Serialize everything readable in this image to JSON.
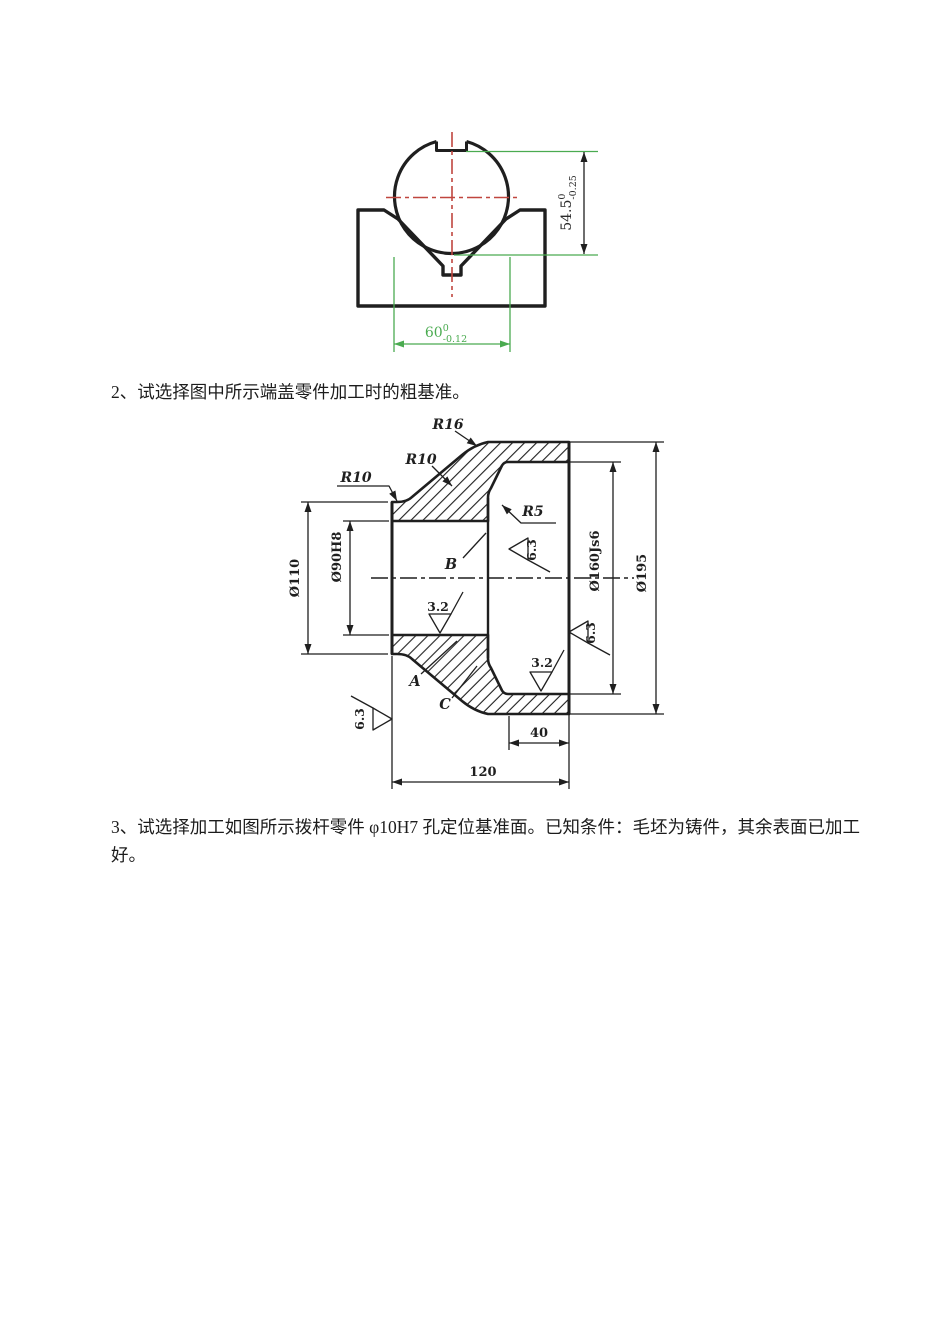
{
  "document": {
    "question2": "2、试选择图中所示端盖零件加工时的粗基准。",
    "question3_line1": "3、试选择加工如图所示拨杆零件 φ10H7 孔定位基准面。已知条件：毛坯为铸件，其余表面已加工",
    "question3_line2": "好。"
  },
  "vblock": {
    "height_dim": {
      "nominal": "54.5",
      "upper_dev": "0",
      "lower_dev": "-0.25"
    },
    "width_dim": {
      "nominal": "60",
      "upper_dev": "0",
      "lower_dev": "-0.12"
    }
  },
  "endcover": {
    "fillets": {
      "r16": "R16",
      "r10_upper": "R10",
      "r10_left": "R10",
      "r5": "R5"
    },
    "point_labels": {
      "a": "A",
      "b": "B",
      "c": "C"
    },
    "roughness": {
      "bore": "3.2",
      "spigot_bottom": "3.2",
      "recess_face": "6.3",
      "front_face": "6.3",
      "left_face": "6.3"
    },
    "diameters": {
      "hub": "Ø110",
      "bore": "Ø90H8",
      "spigot": "Ø160Js6",
      "flange": "Ø195"
    },
    "lengths": {
      "recess_depth": "40",
      "total": "120"
    }
  },
  "colors": {
    "ink": "#1f1f1f",
    "dim_green": "#4aab50",
    "centerline_red": "#c0463f"
  }
}
